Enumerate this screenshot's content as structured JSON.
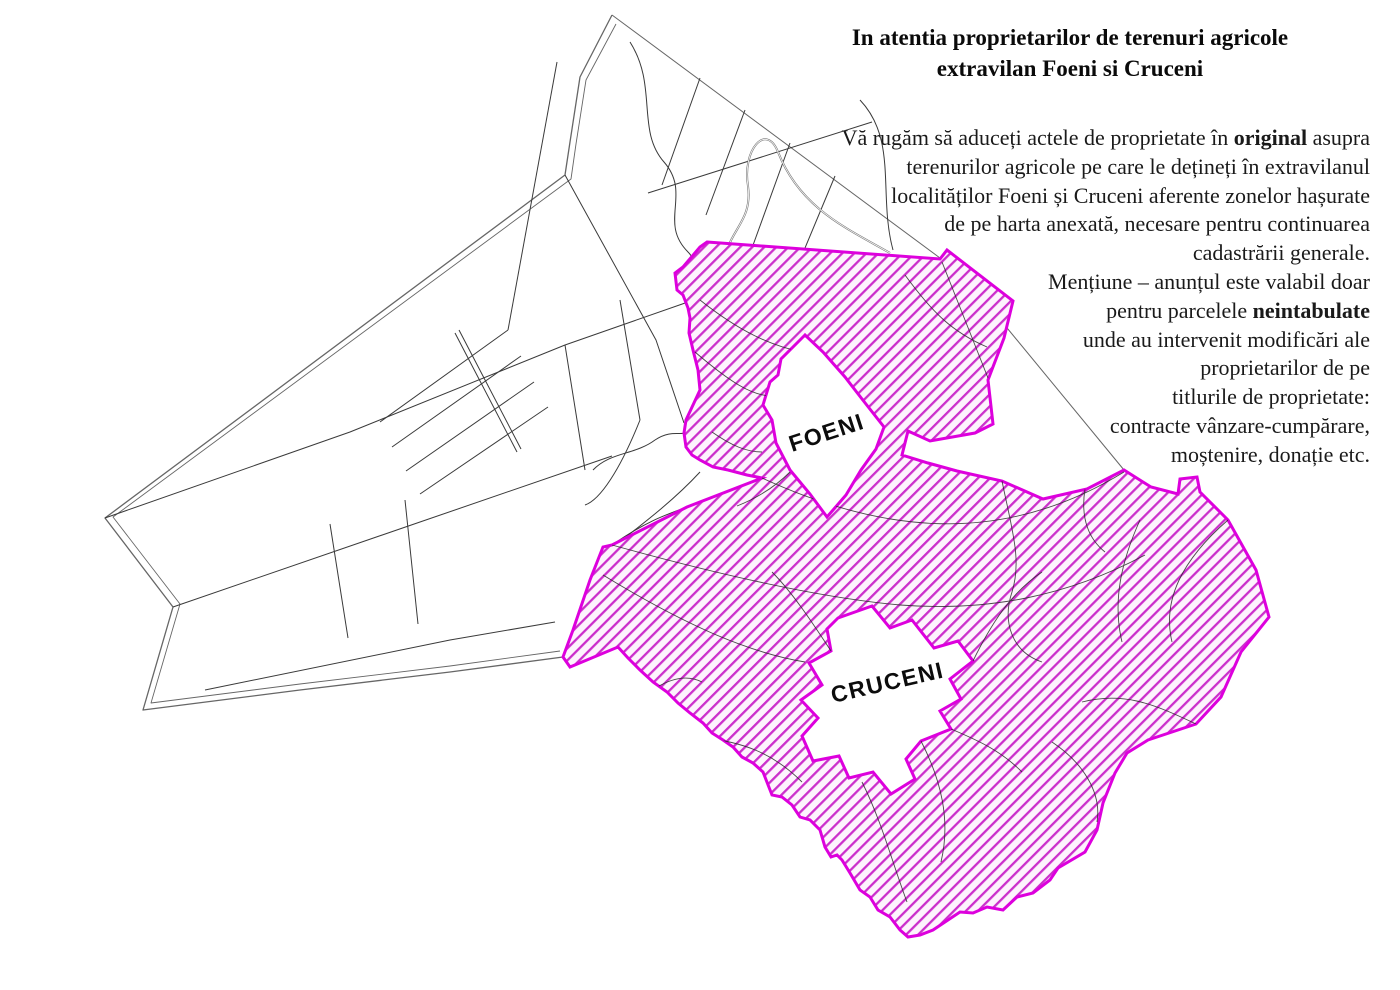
{
  "announcement": {
    "title": {
      "line1": "In atentia proprietarilor de terenuri agricole",
      "line2": "extravilan Foeni si Cruceni"
    },
    "body_lines": {
      "l1_pre": "Vă rugăm să aduceți actele de proprietate în ",
      "l1_bold": "original",
      "l1_post": " asupra",
      "l2": "terenurilor agricole pe care le dețineți în extravilanul",
      "l3": "localităților Foeni și Cruceni aferente zonelor hașurate",
      "l4": "de pe harta anexată, necesare pentru continuarea",
      "l5": "cadastrării generale.",
      "l6": "Mențiune – anunțul este valabil doar",
      "l7_pre": "pentru parcelele ",
      "l7_bold": "neintabulate",
      "l8": "unde au intervenit modificări ale",
      "l9": "proprietarilor de pe",
      "l10": "titlurile de proprietate:",
      "l11": "contracte vânzare-cumpărare,",
      "l12": "moștenire, donație etc."
    }
  },
  "map": {
    "labels": {
      "foeni": "FOENI",
      "cruceni": "CRUCENI"
    },
    "colors": {
      "hatch_line": "#cb2fcb",
      "hatch_background": "#fdf3fd",
      "zone_border": "#dd00dd",
      "parcel_line": "#3a3a3a",
      "boundary_line": "#666666"
    }
  }
}
